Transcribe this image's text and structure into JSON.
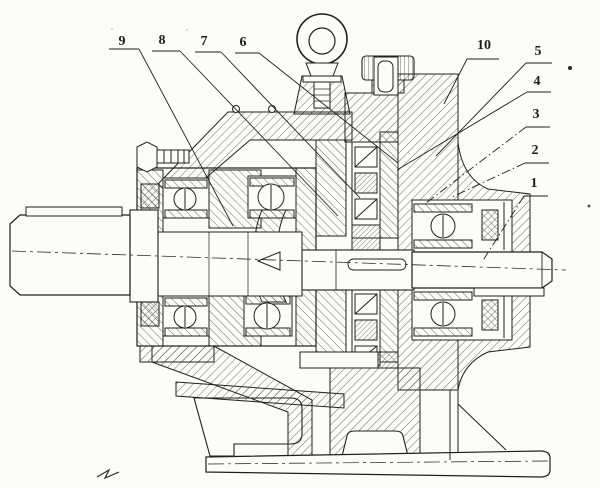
{
  "figure": {
    "ink_color": "#1f1f1f",
    "paper_color": "#fcfcfa"
  },
  "callouts": [
    {
      "label": "9"
    },
    {
      "label": "8"
    },
    {
      "label": "7"
    },
    {
      "label": "6"
    },
    {
      "label": "10"
    },
    {
      "label": "5"
    },
    {
      "label": "4"
    },
    {
      "label": "3"
    },
    {
      "label": "2"
    },
    {
      "label": "1"
    }
  ]
}
